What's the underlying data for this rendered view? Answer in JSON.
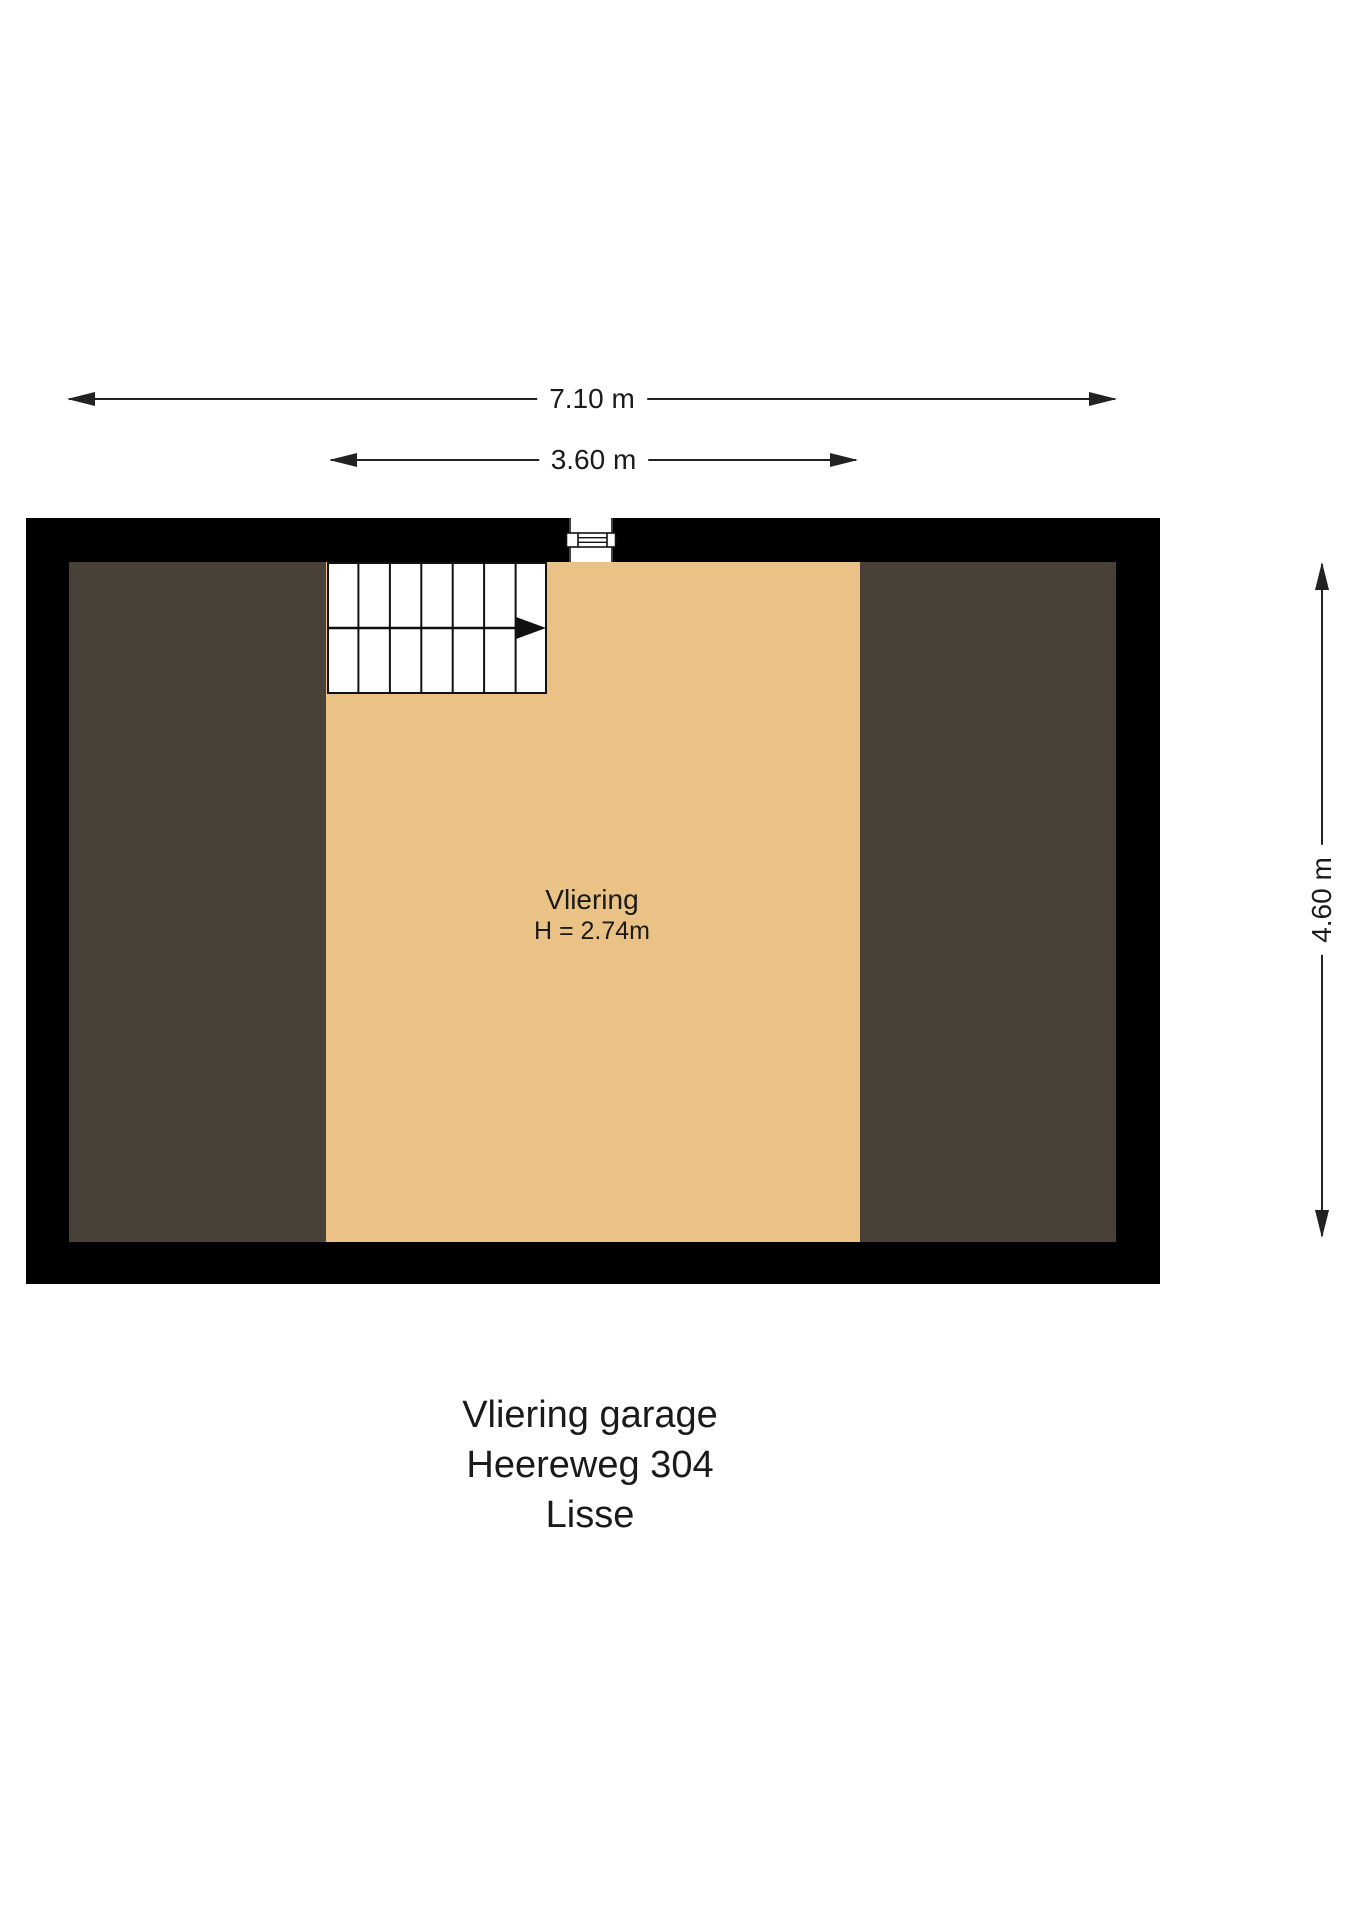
{
  "plan": {
    "dimensions": {
      "total_width": "7.10 m",
      "room_width": "3.60 m",
      "total_depth": "4.60 m"
    },
    "room": {
      "name": "Vliering",
      "ceiling_height": "H = 2.74m"
    },
    "title": {
      "line1": "Vliering garage",
      "line2": "Heereweg 304",
      "line3": "Lisse"
    },
    "colors": {
      "wall": "#000000",
      "attic_floor": "#494138",
      "room_floor": "#eac285",
      "line": "#222222"
    }
  }
}
